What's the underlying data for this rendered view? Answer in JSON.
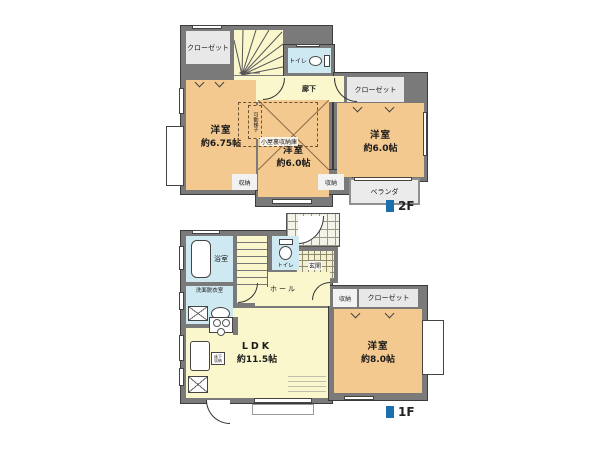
{
  "floor2": {
    "tag": "2F",
    "closet_left": "クローゼット",
    "stairs_dn": "DN",
    "toilet": "トイレ",
    "hallway": "廊下",
    "room_left": {
      "name": "洋室",
      "size": "約6.75帖"
    },
    "room_center": {
      "name": "洋室",
      "size": "約6.0帖"
    },
    "attic_storage": "小屋裏収納庫",
    "ladder": "可動梯子",
    "closet_right": "クローゼット",
    "room_right": {
      "name": "洋室",
      "size": "約6.0帖"
    },
    "storage_left": "収納",
    "storage_right": "収納",
    "veranda": "ベランダ"
  },
  "floor1": {
    "tag": "1F",
    "bath": "浴室",
    "toilet": "トイレ",
    "entrance": "玄関",
    "hall": "ホール",
    "washroom": "洗面脱衣室",
    "storage": "収納",
    "closet": "クローゼット",
    "underfloor": "床下収納",
    "ldk": {
      "name": "LDK",
      "size": "約11.5帖"
    },
    "room": {
      "name": "洋室",
      "size": "約8.0帖"
    }
  },
  "colors": {
    "wall": "#7a7a7a",
    "room_fill": "#f4c98f",
    "corridor_fill": "#fbf7cd",
    "wet_area_fill": "#cfe9f3",
    "closet_fill": "#e8e8e8",
    "floor_tag_accent": "#1c6fad"
  }
}
